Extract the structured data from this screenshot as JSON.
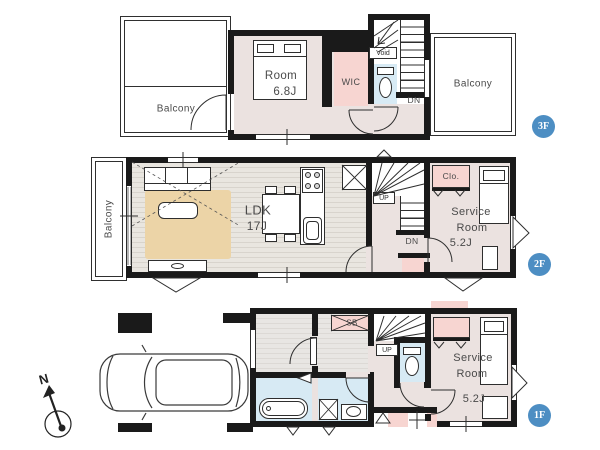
{
  "colors": {
    "wall": "#1a1a1a",
    "floor": "#ebe2e0",
    "closet_pink": "#f7d5d1",
    "wet_area_blue": "#d7eaf4",
    "rug_tan": "#ecd4a7",
    "wood_floor": "#e9e6e0",
    "wood_stripe": "#d8d4cd",
    "hall_grey": "#e8e6e3",
    "hall_stripe": "#dcd9d5",
    "badge_blue": "#4d8ec3",
    "label_grey": "#4a4a4a"
  },
  "floor3": {
    "badge": "3F",
    "balcony_left": "Balcony",
    "balcony_right": "Balcony",
    "room_name": "Room",
    "room_size": "6.8J",
    "wic": "WIC",
    "void": "Void",
    "down": "DN"
  },
  "floor2": {
    "badge": "2F",
    "balcony": "Balcony",
    "ldk_name": "LDK",
    "ldk_size": "17J",
    "up": "UP",
    "down": "DN",
    "closet": "Clo.",
    "service_room": {
      "line1": "Service",
      "line2": "Room",
      "size": "5.2J"
    }
  },
  "floor1": {
    "badge": "1F",
    "north": "N",
    "shoe_box": "SB",
    "up": "UP",
    "service_room": {
      "line1": "Service",
      "line2": "Room",
      "size": "5.2J"
    }
  }
}
